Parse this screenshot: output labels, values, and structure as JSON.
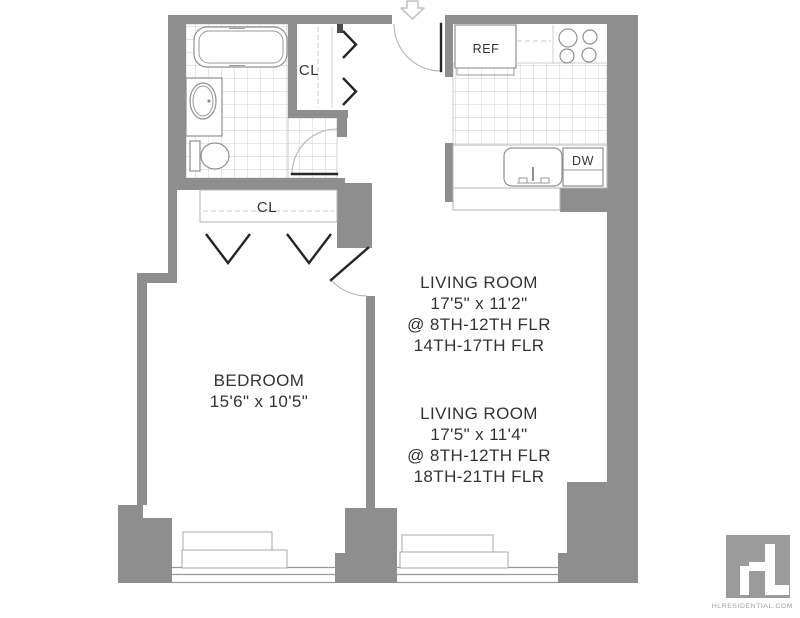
{
  "rooms": {
    "bedroom": {
      "name": "BEDROOM",
      "dimensions": "15'6\" x 10'5\""
    },
    "living_room_a": {
      "name": "LIVING ROOM",
      "dimensions": "17'5\" x 11'2\"",
      "floors_line1": "@ 8TH-12TH FLR",
      "floors_line2": "14TH-17TH FLR"
    },
    "living_room_b": {
      "name": "LIVING ROOM",
      "dimensions": "17'5\" x 11'4\"",
      "floors_line1": "@ 8TH-12TH FLR",
      "floors_line2": "18TH-21TH FLR"
    },
    "closet_hall": {
      "label": "CL"
    },
    "closet_bedroom": {
      "label": "CL"
    }
  },
  "kitchen": {
    "refrigerator_label": "REF",
    "dishwasher_label": "DW"
  },
  "branding": {
    "logo_text": "HL",
    "website": "HLRESIDENTIAL.COM"
  },
  "colors": {
    "wall": "#8e8e8e",
    "tile_line": "#cccccc",
    "fixture_line": "#909090",
    "door_leaf": "#262626",
    "door_swing": "#b5b5b5",
    "label_text": "#333333",
    "logo_background": "#9b9b9b",
    "logo_glyph": "#ffffff",
    "website_text": "#a0a0a0"
  }
}
